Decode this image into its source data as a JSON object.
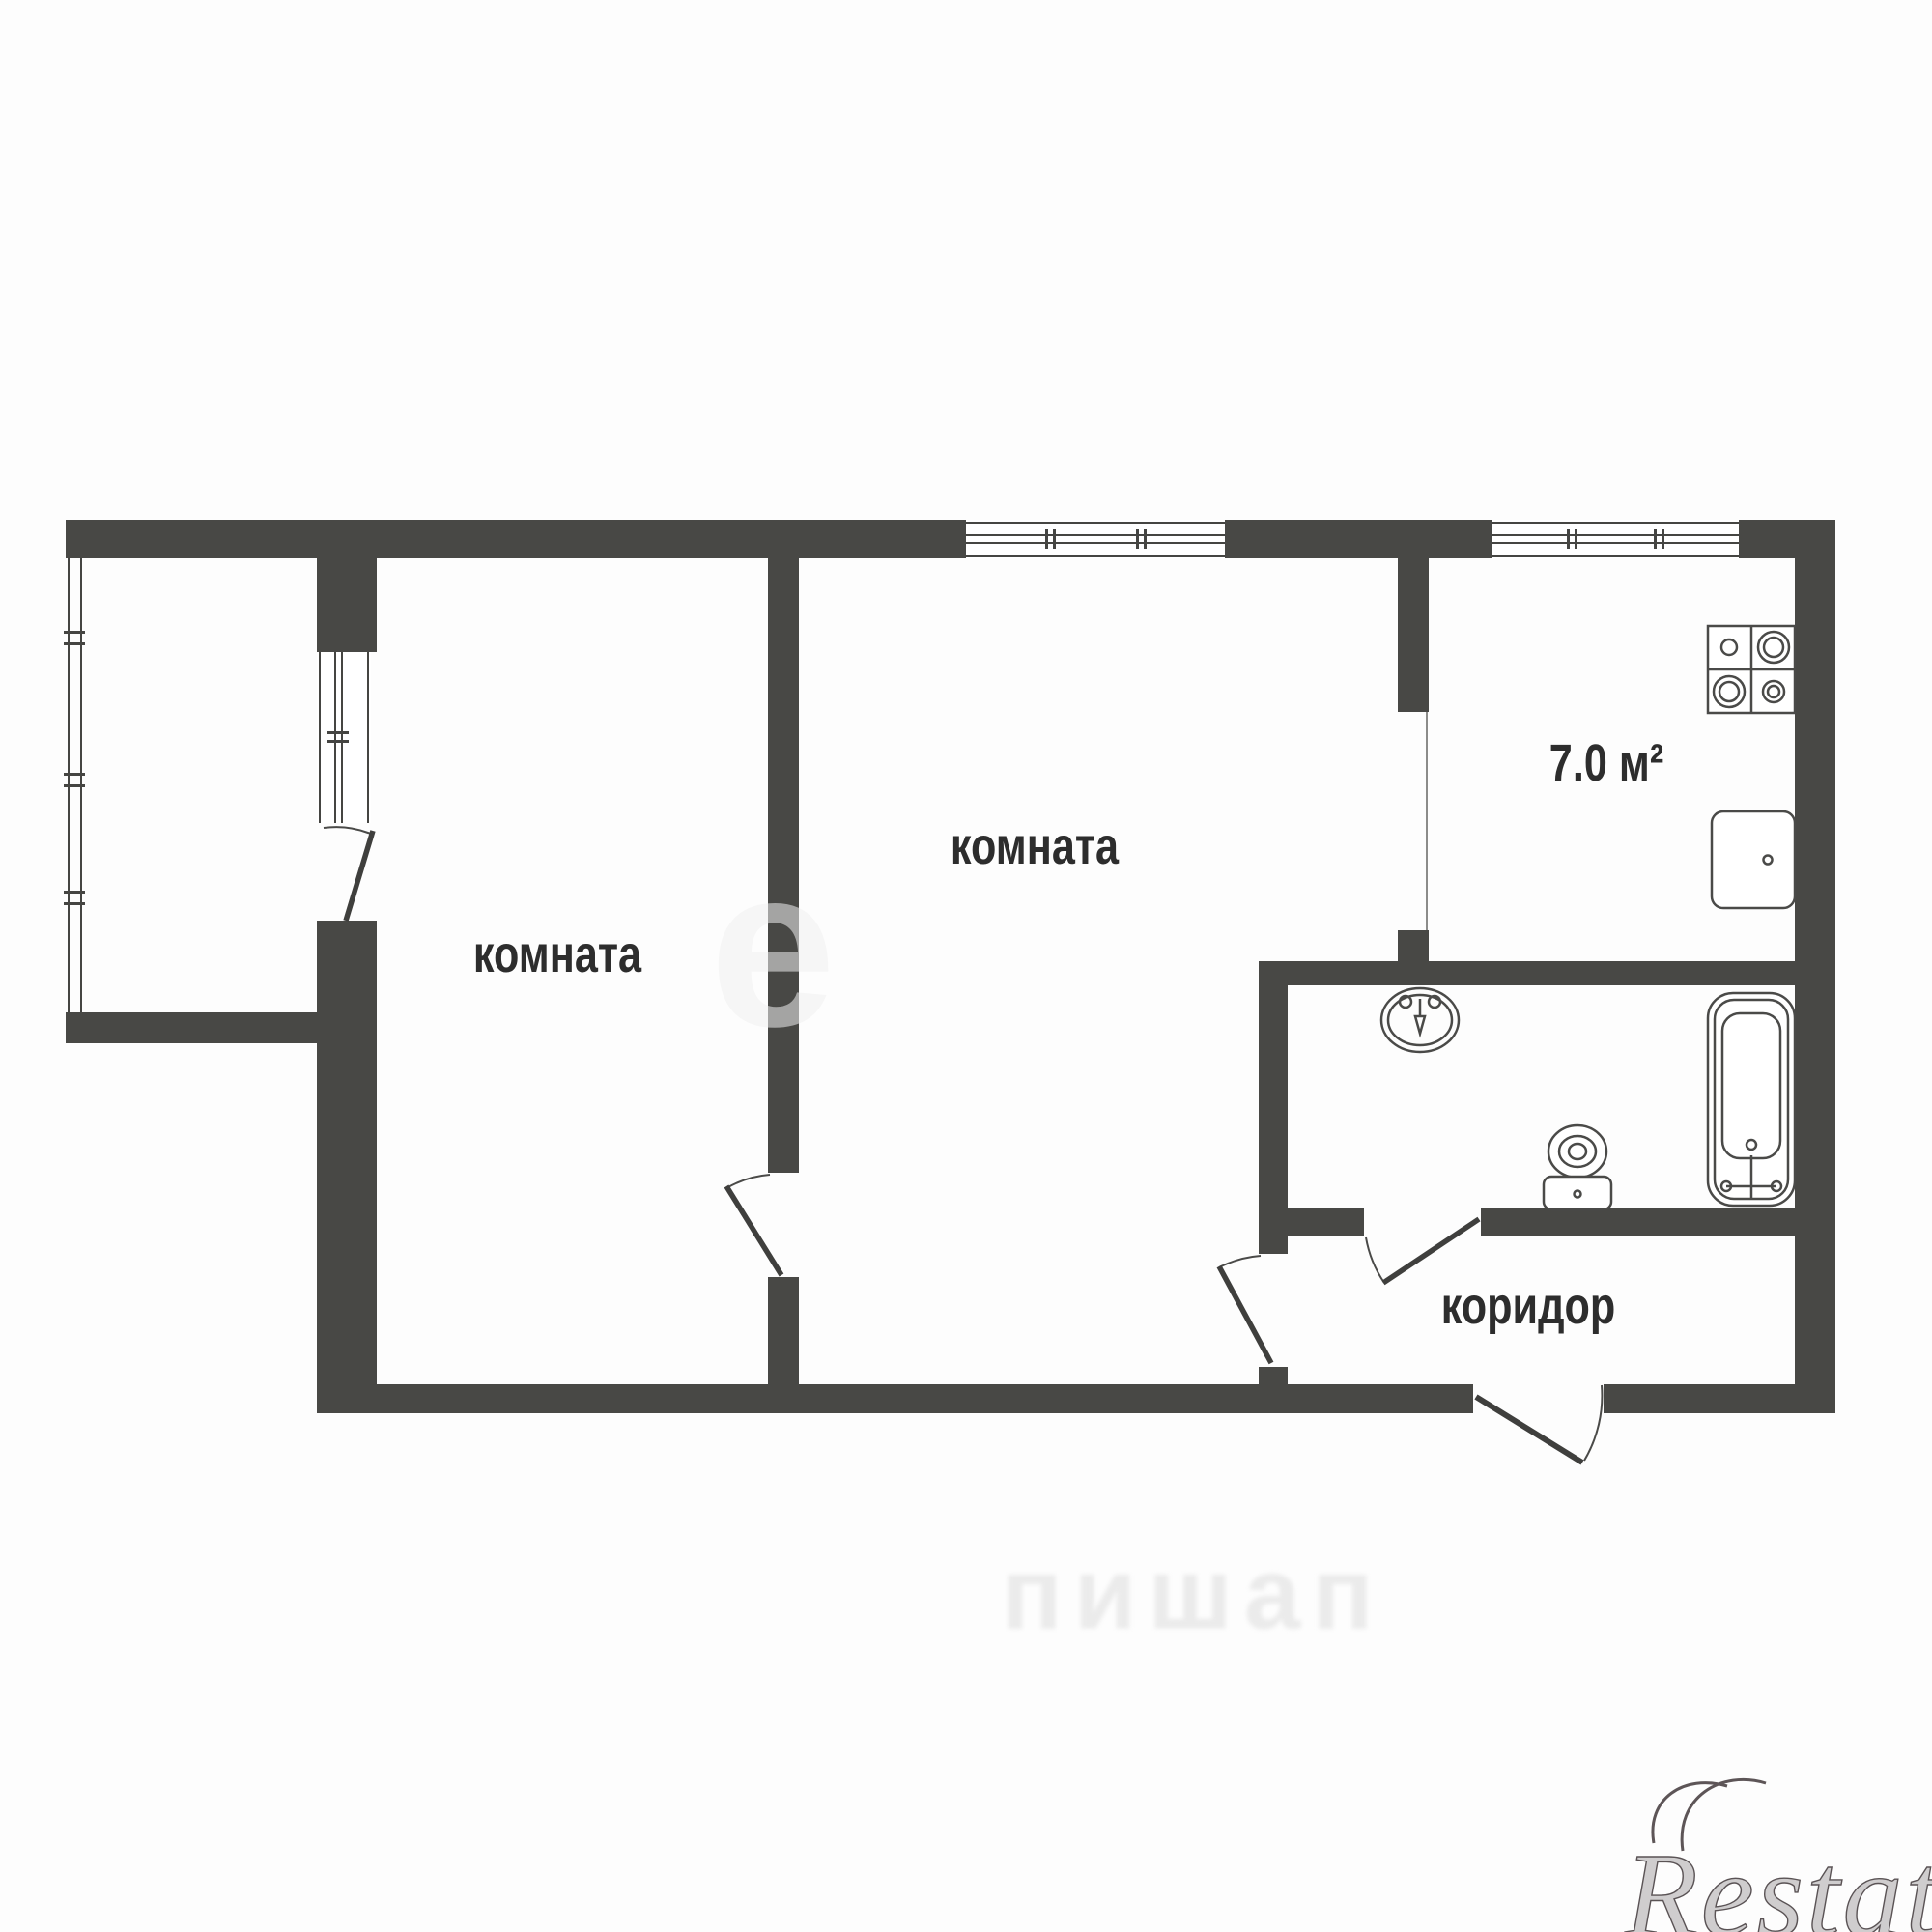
{
  "page": {
    "background": "#fdfdfd"
  },
  "floor_plan": {
    "labels": {
      "room_left": "комната",
      "room_main": "комната",
      "kitchen_area": "7.0 м²",
      "corridor": "коридор"
    },
    "fixtures": [
      "stove-icon",
      "kitchen-sink-icon",
      "wash-basin-icon",
      "toilet-icon",
      "bathtub-icon"
    ],
    "colors": {
      "wall": "#484845",
      "line": "#454542",
      "text": "#2d2d2d",
      "watermark": "#5a5355"
    }
  },
  "watermarks": {
    "brand": "Restate",
    "center_glyph": "е",
    "bottom_blurred": "пишап"
  }
}
